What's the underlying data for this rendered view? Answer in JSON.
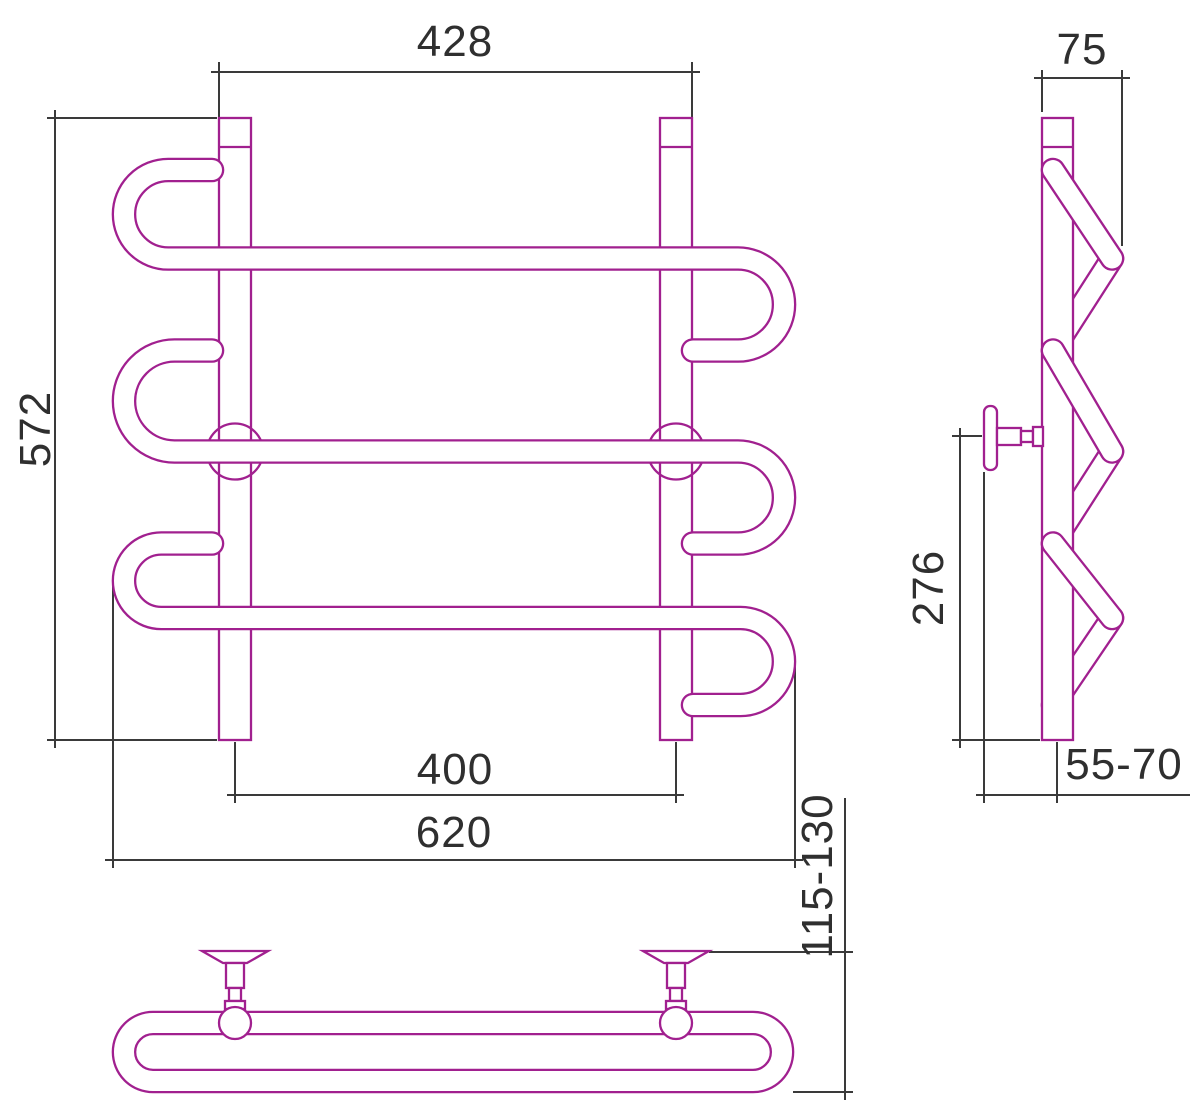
{
  "drawing": {
    "kind": "towel-rail-dimension-drawing"
  },
  "colors": {
    "product-outline": "#a1208f",
    "dimension-line": "#3a3a3a",
    "text": "#2f2f2f",
    "background": "#ffffff"
  },
  "views": {
    "front": {
      "dims": {
        "posts_outer_width": "428",
        "height": "572",
        "posts_center_spacing": "400",
        "overall_width": "620"
      }
    },
    "side": {
      "dims": {
        "depth": "75",
        "bracket_to_bottom": "276",
        "wall_clearance": "55-70"
      }
    },
    "top": {
      "dims": {
        "wall_offset": "115-130"
      }
    }
  }
}
